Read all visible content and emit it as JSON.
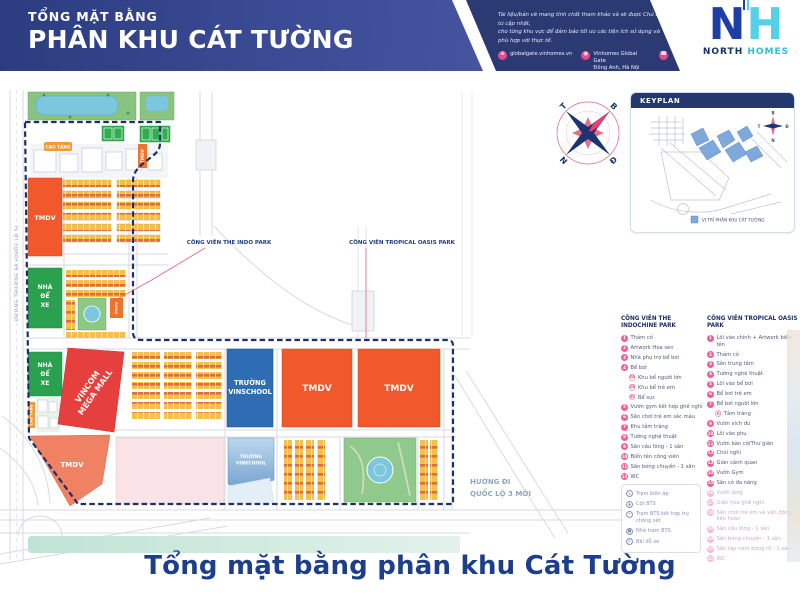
{
  "header": {
    "subtitle": "TỔNG MẶT BẰNG",
    "title": "PHÂN KHU CÁT TƯỜNG",
    "disclaimer_line1": "Tài liệu/bản vẽ mang tính chất tham khảo và sẽ được Chủ đầu tư cập nhật,",
    "disclaimer_line2": "cho từng khu vực để đảm bảo tối ưu các tiện ích sử dụng và phù hợp với thực tế.",
    "contact_website": "globalgate.vinhomes.vn",
    "contact_address_line1": "Vinhomes Global Gate",
    "contact_address_line2": "Đông Anh, Hà Nội",
    "logo_letter1": "N",
    "logo_letter2": "H",
    "logo_word1": "NORTH",
    "logo_word2": "HOMES"
  },
  "map": {
    "left_road_label": "ĐƯỜNG TRƯỜNG SA (QUỐC LỘ 5)",
    "callout_indo_park": "CÔNG VIÊN THE INDO PARK",
    "callout_tropical_park": "CÔNG VIÊN TROPICAL OASIS PARK",
    "label_cao_tang": "CAO TẦNG",
    "label_tmdv": "TMDV",
    "label_nha_1": "NHÀ",
    "label_nha_2": "ĐỂ",
    "label_nha_3": "XE",
    "label_vincom_1": "VINCOM",
    "label_vincom_2": "MEGA MALL",
    "label_school_1": "TRƯỜNG",
    "label_school_2": "VINSCHOOL",
    "direction_line1": "HƯỚNG ĐI",
    "direction_line2": "QUỐC LỘ 3 MỚI"
  },
  "compass": {
    "north": "B",
    "east": "Đ",
    "south": "N",
    "west": "T"
  },
  "keyplan": {
    "title": "KEYPLAN",
    "legend_label": "VỊ TRÍ PHÂN KHU CÁT TƯỜNG",
    "compass_north": "B",
    "compass_east": "Đ",
    "compass_south": "N",
    "compass_west": "T"
  },
  "legend": {
    "col1_title": "CÔNG VIÊN THE INDOCHINE PARK",
    "col1_items": [
      {
        "n": "1",
        "label": "Thảm cỏ"
      },
      {
        "n": "2",
        "label": "Artwork Hoa sen"
      },
      {
        "n": "3",
        "label": "Nhà phụ trợ bể bơi"
      },
      {
        "n": "4",
        "label": "Bể bơi"
      },
      {
        "n": "4A",
        "label": "Khu bể người lớn",
        "cls": "sub"
      },
      {
        "n": "4B",
        "label": "Khu bể trẻ em",
        "cls": "sub"
      },
      {
        "n": "4C",
        "label": "Bể sục",
        "cls": "sub"
      },
      {
        "n": "5",
        "label": "Vườn gym kết hợp ghế nghỉ"
      },
      {
        "n": "6",
        "label": "Sân chơi trẻ em sắc màu"
      },
      {
        "n": "7",
        "label": "Khu tắm tráng"
      },
      {
        "n": "8",
        "label": "Tường nghệ thuật"
      },
      {
        "n": "9",
        "label": "Sân cầu lông - 1 sân"
      },
      {
        "n": "10",
        "label": "Biển tên công viên"
      },
      {
        "n": "11",
        "label": "Sân bóng chuyền - 1 sân"
      },
      {
        "n": "12",
        "label": "WC"
      }
    ],
    "utilities": [
      {
        "glyph": "↯",
        "label": "Trạm biến áp"
      },
      {
        "glyph": "▲",
        "label": "Cột BTS"
      },
      {
        "glyph": "+",
        "label": "Trạm BTS kết hợp trụ chống sét"
      },
      {
        "glyph": "■",
        "label": "Nhà trạm BTS"
      },
      {
        "glyph": "P",
        "label": "Bãi đỗ xe"
      }
    ],
    "col2_title": "CÔNG VIÊN TROPICAL OASIS PARK",
    "col2_items": [
      {
        "n": "1",
        "label": "Lối vào chính + Artwork biển tên"
      },
      {
        "n": "2",
        "label": "Thảm cỏ"
      },
      {
        "n": "3",
        "label": "Sân trung tâm"
      },
      {
        "n": "4",
        "label": "Tường nghệ thuật"
      },
      {
        "n": "5",
        "label": "Lối vào bể bơi"
      },
      {
        "n": "6",
        "label": "Bể bơi trẻ em"
      },
      {
        "n": "7",
        "label": "Bể bơi người lớn"
      },
      {
        "n": "8",
        "label": "Tắm tráng",
        "cls": "sub"
      },
      {
        "n": "9",
        "label": "Vườn xích đu"
      },
      {
        "n": "10",
        "label": "Lối vào phụ"
      },
      {
        "n": "11",
        "label": "Vườn bàn cờ/Thư giãn"
      },
      {
        "n": "12",
        "label": "Chòi nghỉ"
      },
      {
        "n": "13",
        "label": "Giàn cảnh quan"
      },
      {
        "n": "14",
        "label": "Vườn Gym"
      },
      {
        "n": "15",
        "label": "Sân cỏ đa năng"
      },
      {
        "n": "16",
        "label": "Vườn lắng",
        "cls": "faded"
      },
      {
        "n": "17",
        "label": "Giàn hoa ghế nghỉ",
        "cls": "faded"
      },
      {
        "n": "18",
        "label": "Sân chơi trẻ em và vận động liên hoàn",
        "cls": "faded"
      },
      {
        "n": "19",
        "label": "Sân cầu lông - 1 sân",
        "cls": "faded"
      },
      {
        "n": "20",
        "label": "Sân bóng chuyền - 1 sân",
        "cls": "faded"
      },
      {
        "n": "21",
        "label": "Sân tập ném bóng rổ - 1 sân",
        "cls": "faded"
      },
      {
        "n": "22",
        "label": "WC",
        "cls": "faded"
      }
    ]
  },
  "footer": {
    "title": "Tổng mặt bằng phân khu Cát Tường"
  },
  "colors": {
    "accent_navy": "#24386f",
    "accent_pink": "#ee5f97",
    "tmdv_orange": "#f1582b",
    "parking_green": "#2aa14e",
    "mall_red": "#e5403e",
    "school_blue": "#2e6cb3",
    "water_blue": "#7cc6de",
    "boundary_navy": "#1d2f6b"
  }
}
